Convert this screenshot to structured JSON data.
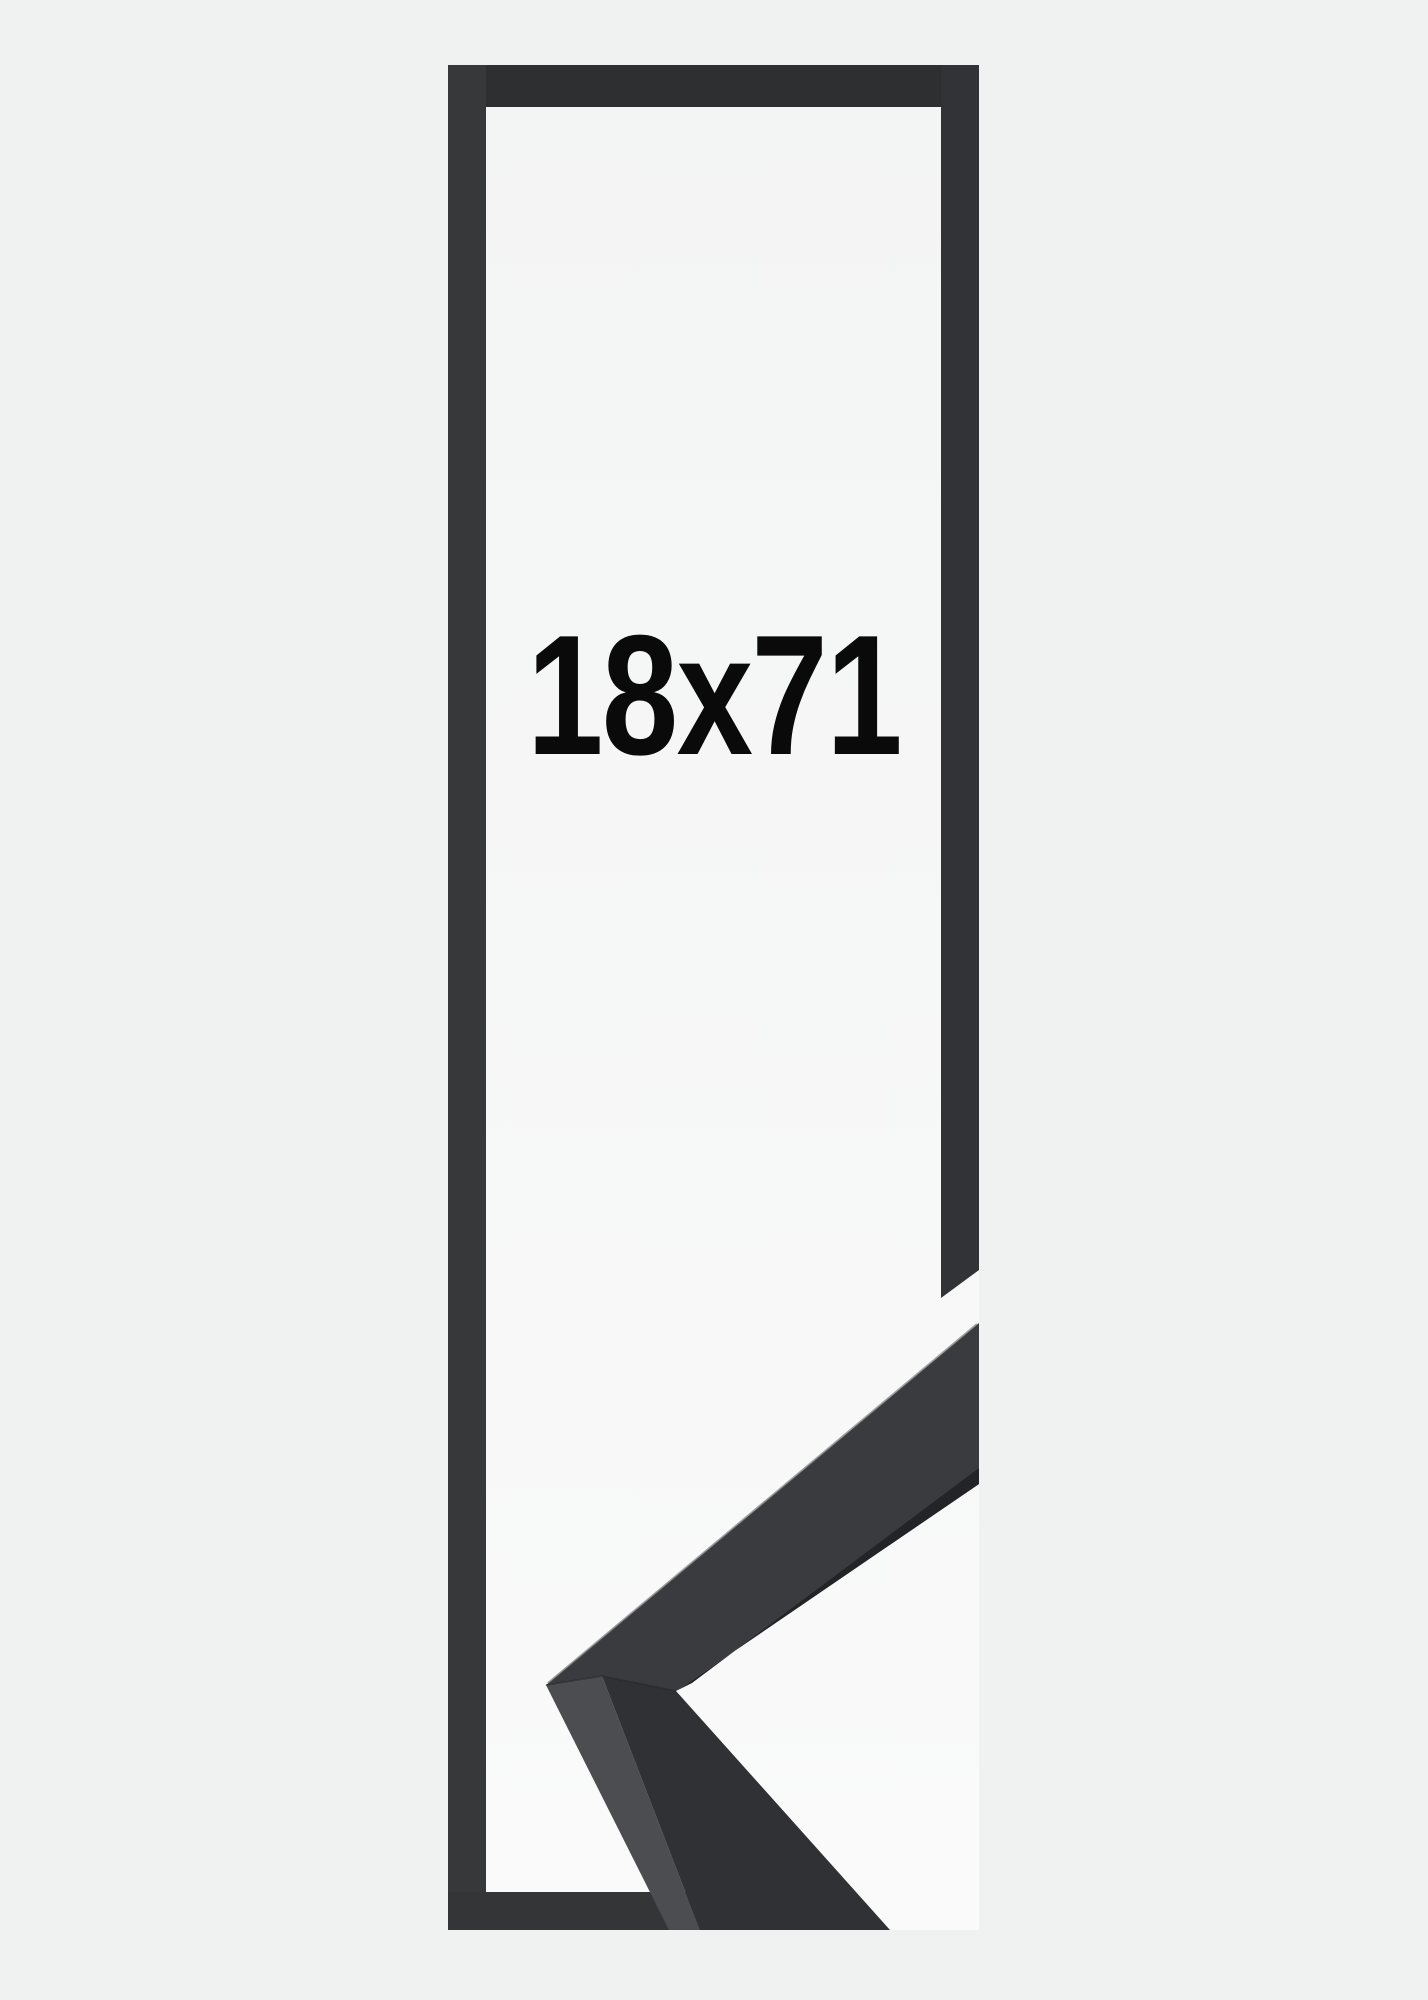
{
  "product": {
    "size_label": "18x71"
  },
  "colors": {
    "page_bg": "#f0f1f1",
    "interior_top": "#f3f4f4",
    "interior_bottom": "#fafafa",
    "frame_top": "#2e2f31",
    "frame_left": "#37383a",
    "frame_right": "#323336",
    "frame_bottom": "#343537",
    "sample_face_upper": "#3a3b3e",
    "sample_face_lower": "#303134",
    "sample_top_facet": "#4b4d50",
    "sample_inner_edge": "#232427",
    "sample_highlight": "#6e7073",
    "sample_seam": "#1d1e20",
    "label_text": "#0a0a0b"
  }
}
